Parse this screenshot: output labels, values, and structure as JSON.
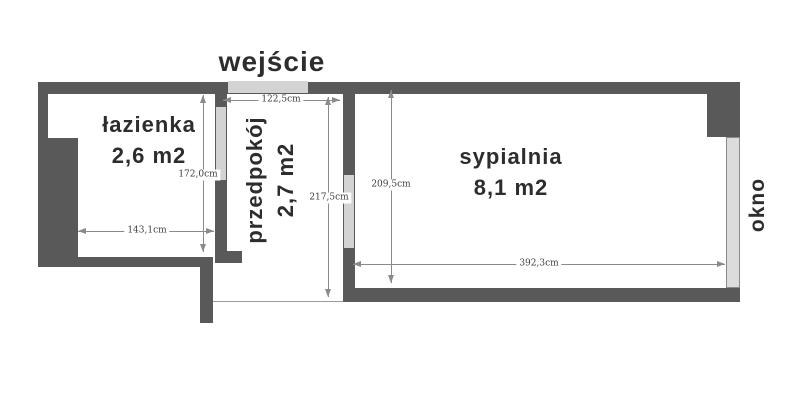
{
  "entrance_label": "wejście",
  "window_label": "okno",
  "rooms": {
    "bathroom": {
      "name": "łazienka",
      "area": "2,6 m2"
    },
    "hallway": {
      "name": "przedpokój",
      "area": "2,7 m2"
    },
    "bedroom": {
      "name": "sypialnia",
      "area": "8,1 m2"
    }
  },
  "dimensions": {
    "entrance_width": "122,5cm",
    "bathroom_height": "172,0cm",
    "bathroom_width": "143,1cm",
    "hallway_height": "217,5cm",
    "bedroom_height": "209,5cm",
    "bedroom_width": "392,3cm"
  },
  "colors": {
    "wall": "#595959",
    "opening": "#d3d3d3",
    "background": "#ffffff",
    "dimension_line": "#8a8a8a",
    "label_text": "#2d2d2d"
  }
}
